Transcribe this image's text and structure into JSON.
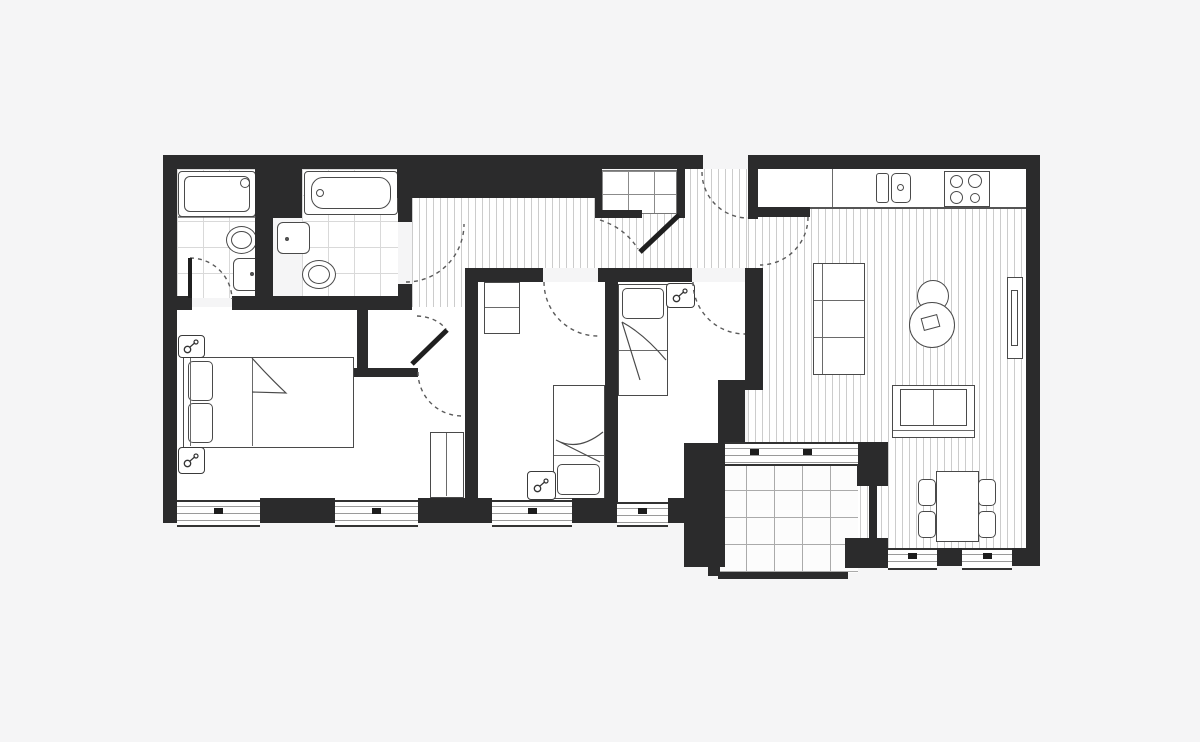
{
  "meta": {
    "title": "apartment-floor-plan",
    "visible_text": []
  },
  "palette": {
    "background": "#f5f5f6",
    "wall": "#2b2b2c",
    "fixture_outline": "#4a4a4a",
    "floor_line": "#cccccc",
    "tile_line": "#d9d9d9",
    "door_arc": "#5a5a5a"
  },
  "icons": {
    "utility_symbol": {
      "name": "key-socket-icon",
      "glyph": "two-circles-diagonal-link",
      "count": 4
    }
  },
  "rooms": [
    {
      "name": "ensuite-bathroom",
      "floor": "tile",
      "fixtures": [
        "shower-tray",
        "toilet",
        "wash-basin"
      ],
      "doors": [
        "hinged-from-master-bedroom"
      ]
    },
    {
      "name": "main-bathroom",
      "floor": "tile",
      "fixtures": [
        "bathtub",
        "wall-basin",
        "toilet"
      ],
      "doors": [
        "hinged-from-hallway"
      ]
    },
    {
      "name": "hallway",
      "floor": "plank",
      "fixtures": [
        "storage-closet-with-shelves",
        "storage-cupboard"
      ],
      "doors": [
        "entrance-door",
        "closet-door",
        "cupboard-door",
        "inner-hall-door"
      ]
    },
    {
      "name": "master-bedroom",
      "floor": "plain",
      "fixtures": [
        "double-bed",
        "two-pillows",
        "wardrobe",
        "utility-symbol-x2"
      ],
      "windows": 2
    },
    {
      "name": "bedroom-2",
      "floor": "plain",
      "fixtures": [
        "single-bed",
        "wardrobe",
        "utility-symbol"
      ],
      "windows": 1
    },
    {
      "name": "bedroom-3",
      "floor": "plain",
      "fixtures": [
        "single-bed",
        "utility-symbol"
      ],
      "windows": 1
    },
    {
      "name": "kitchen-living-dining",
      "floor": "plank",
      "fixtures": [
        "kitchen-counter",
        "double-sink",
        "four-ring-hob",
        "tall-cabinet",
        "round-chair",
        "round-side-table",
        "tv-unit",
        "two-seat-sofa",
        "dining-table",
        "four-dining-chairs"
      ],
      "windows": 2
    },
    {
      "name": "balcony",
      "floor": "large-grid-tile",
      "fixtures": [
        "sliding-door"
      ],
      "access": "from-living-room"
    }
  ]
}
